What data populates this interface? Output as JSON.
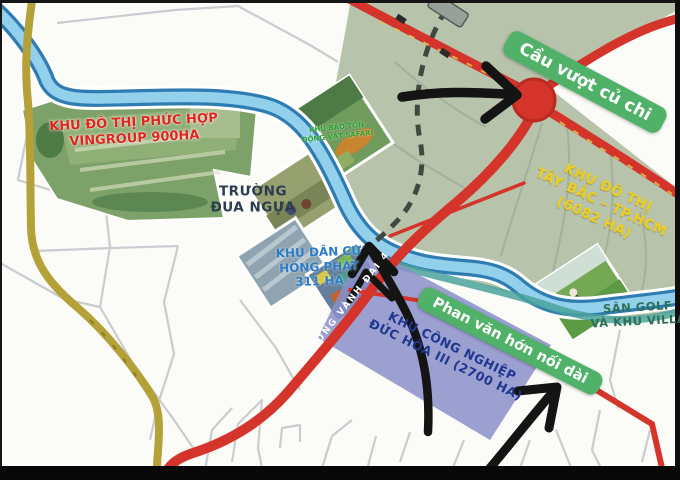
{
  "labels": {
    "vingroup": {
      "line1": "KHU ĐÔ THỊ PHỨC HỢP",
      "line2": "VINGROUP 900HA"
    },
    "racecourse": {
      "line1": "TRƯỜNG",
      "line2": "ĐUA NGỰA"
    },
    "safari": {
      "line1": "KHU BẢO TỒN",
      "line2": "ĐỘNG VẬT SAFARI"
    },
    "hong_phat": {
      "line1": "KHU DÂN CƯ",
      "line2": "HỒNG PHÁT",
      "line3": "311 HA"
    },
    "tay_bac": {
      "line1": "KHU ĐÔ THỊ",
      "line2": "TÂY BẮC – TP.HCM",
      "line3": "(6082 HA)"
    },
    "vanh_dai": {
      "text": "ĐƯỜNG VÀNH ĐAI 4"
    },
    "golf": {
      "line1": "SÂN GOLF",
      "line2": "VÀ KHU VILLA"
    },
    "duc_hoa": {
      "line1": "KHU CÔNG NGHIỆP",
      "line2": "ĐỨC HÒA III (2700 HA)"
    },
    "cau_vuot": {
      "text": "Cầu vượt củ chi"
    },
    "phan_van_hon": {
      "text": "Phan văn hớn nối dài"
    }
  },
  "colors": {
    "highlight_pill": "#50b269",
    "main_road_red": "#d5342b",
    "river_light": "#92d0ec",
    "river_edge": "#2e7cb2",
    "provincial_road_yellow": "#b4a238",
    "urban_zone_green": "#b7c3ab",
    "industrial_zone_purple": "#8a8fc9",
    "zone_label_yellow": "#eecf1d",
    "annotation_arrow_black": "#141414"
  }
}
